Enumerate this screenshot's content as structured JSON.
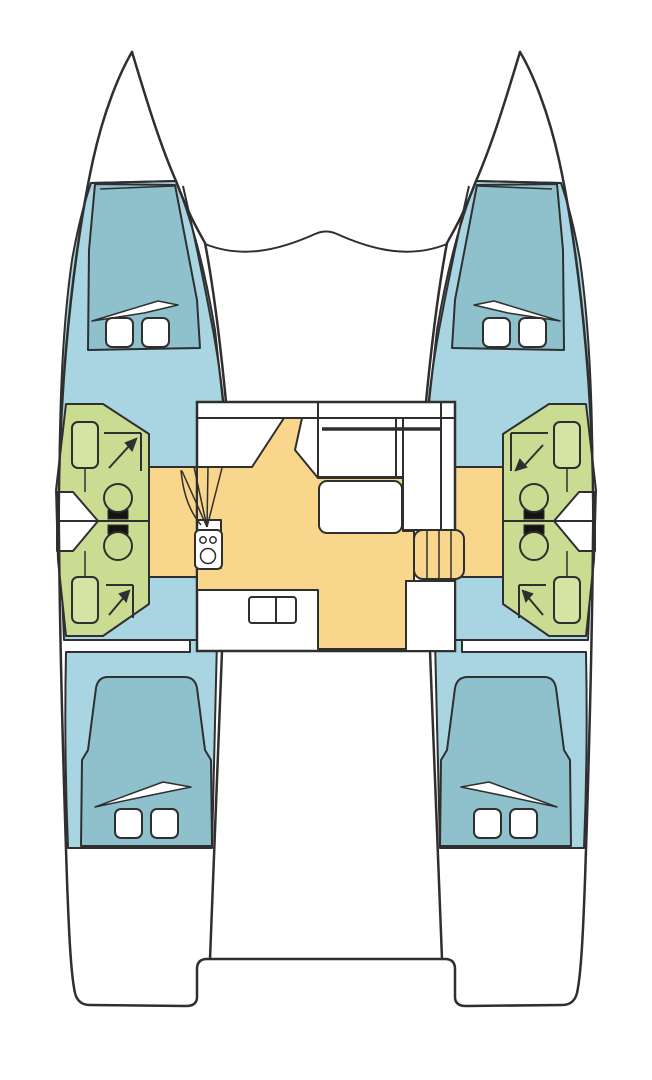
{
  "diagram": {
    "type": "boat-floor-plan",
    "vessel": "catamaran",
    "view": "top-down deck layout"
  },
  "colors": {
    "background": "#ffffff",
    "hull": "#ffffff",
    "outline": "#2f2f2f",
    "floor": "#a9d5e2",
    "bed": "#8ec1cc",
    "bathroom": "#c9dc92",
    "fixture": "#d5e4a4",
    "salon": "#f8d78d",
    "white": "#ffffff",
    "black": "#141414"
  },
  "features": {
    "forward_cabins": 2,
    "aft_cabins": 2,
    "double_berths": 4,
    "pillows": 8,
    "bathrooms": 4,
    "toilets": 4,
    "wash_basins": 4,
    "showers": 4,
    "companionway_stairs": 2,
    "galley_stove_burners": 3,
    "galley_sink_bowls": 2,
    "dinette_tables": 1
  },
  "rooms": [
    {
      "id": "forward-cabin-port",
      "label": "Forward cabin (port)"
    },
    {
      "id": "forward-cabin-starboard",
      "label": "Forward cabin (starboard)"
    },
    {
      "id": "aft-cabin-port",
      "label": "Aft cabin (port)"
    },
    {
      "id": "aft-cabin-starboard",
      "label": "Aft cabin (starboard)"
    },
    {
      "id": "head-port-forward",
      "label": "Bathroom (port fwd)"
    },
    {
      "id": "head-port-aft",
      "label": "Bathroom (port aft)"
    },
    {
      "id": "head-starboard-forward",
      "label": "Bathroom (stbd fwd)"
    },
    {
      "id": "head-starboard-aft",
      "label": "Bathroom (stbd aft)"
    },
    {
      "id": "salon",
      "label": "Salon / galley"
    },
    {
      "id": "foredeck",
      "label": "Foredeck"
    },
    {
      "id": "cockpit",
      "label": "Aft deck"
    }
  ]
}
